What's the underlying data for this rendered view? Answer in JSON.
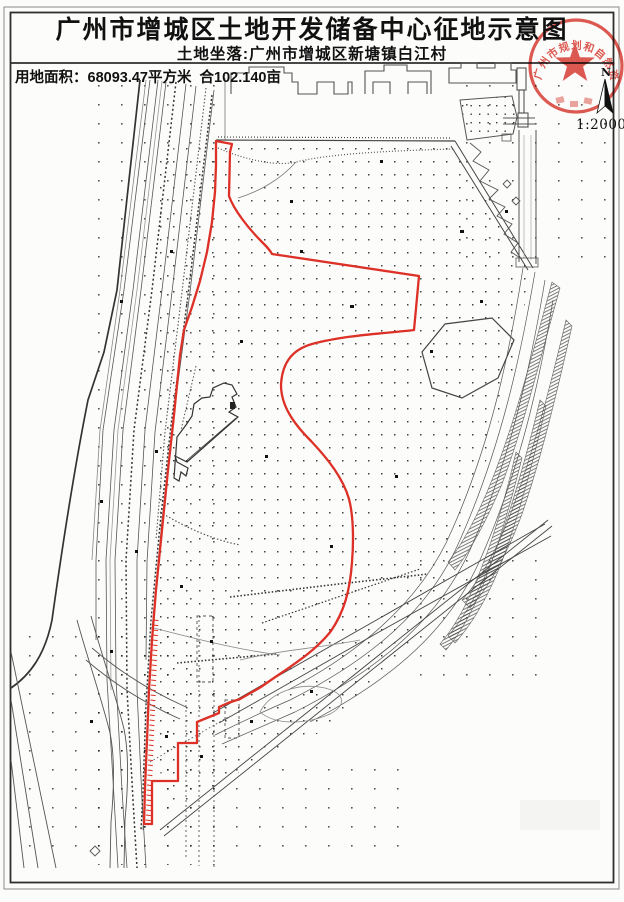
{
  "page": {
    "title": "广州市增城区土地开发储备中心征地示意图",
    "subtitle": "土地坐落:广州市增城区新塘镇白江村",
    "area_label": "用地面积：68093.47平方米  合102.140亩"
  },
  "map": {
    "scale_label": "1:2000",
    "north_label": "N",
    "boundary_color": "#dd3026"
  },
  "seal": {
    "arc_text": "广州市规划和自然资源局",
    "color": "#d8352b"
  }
}
